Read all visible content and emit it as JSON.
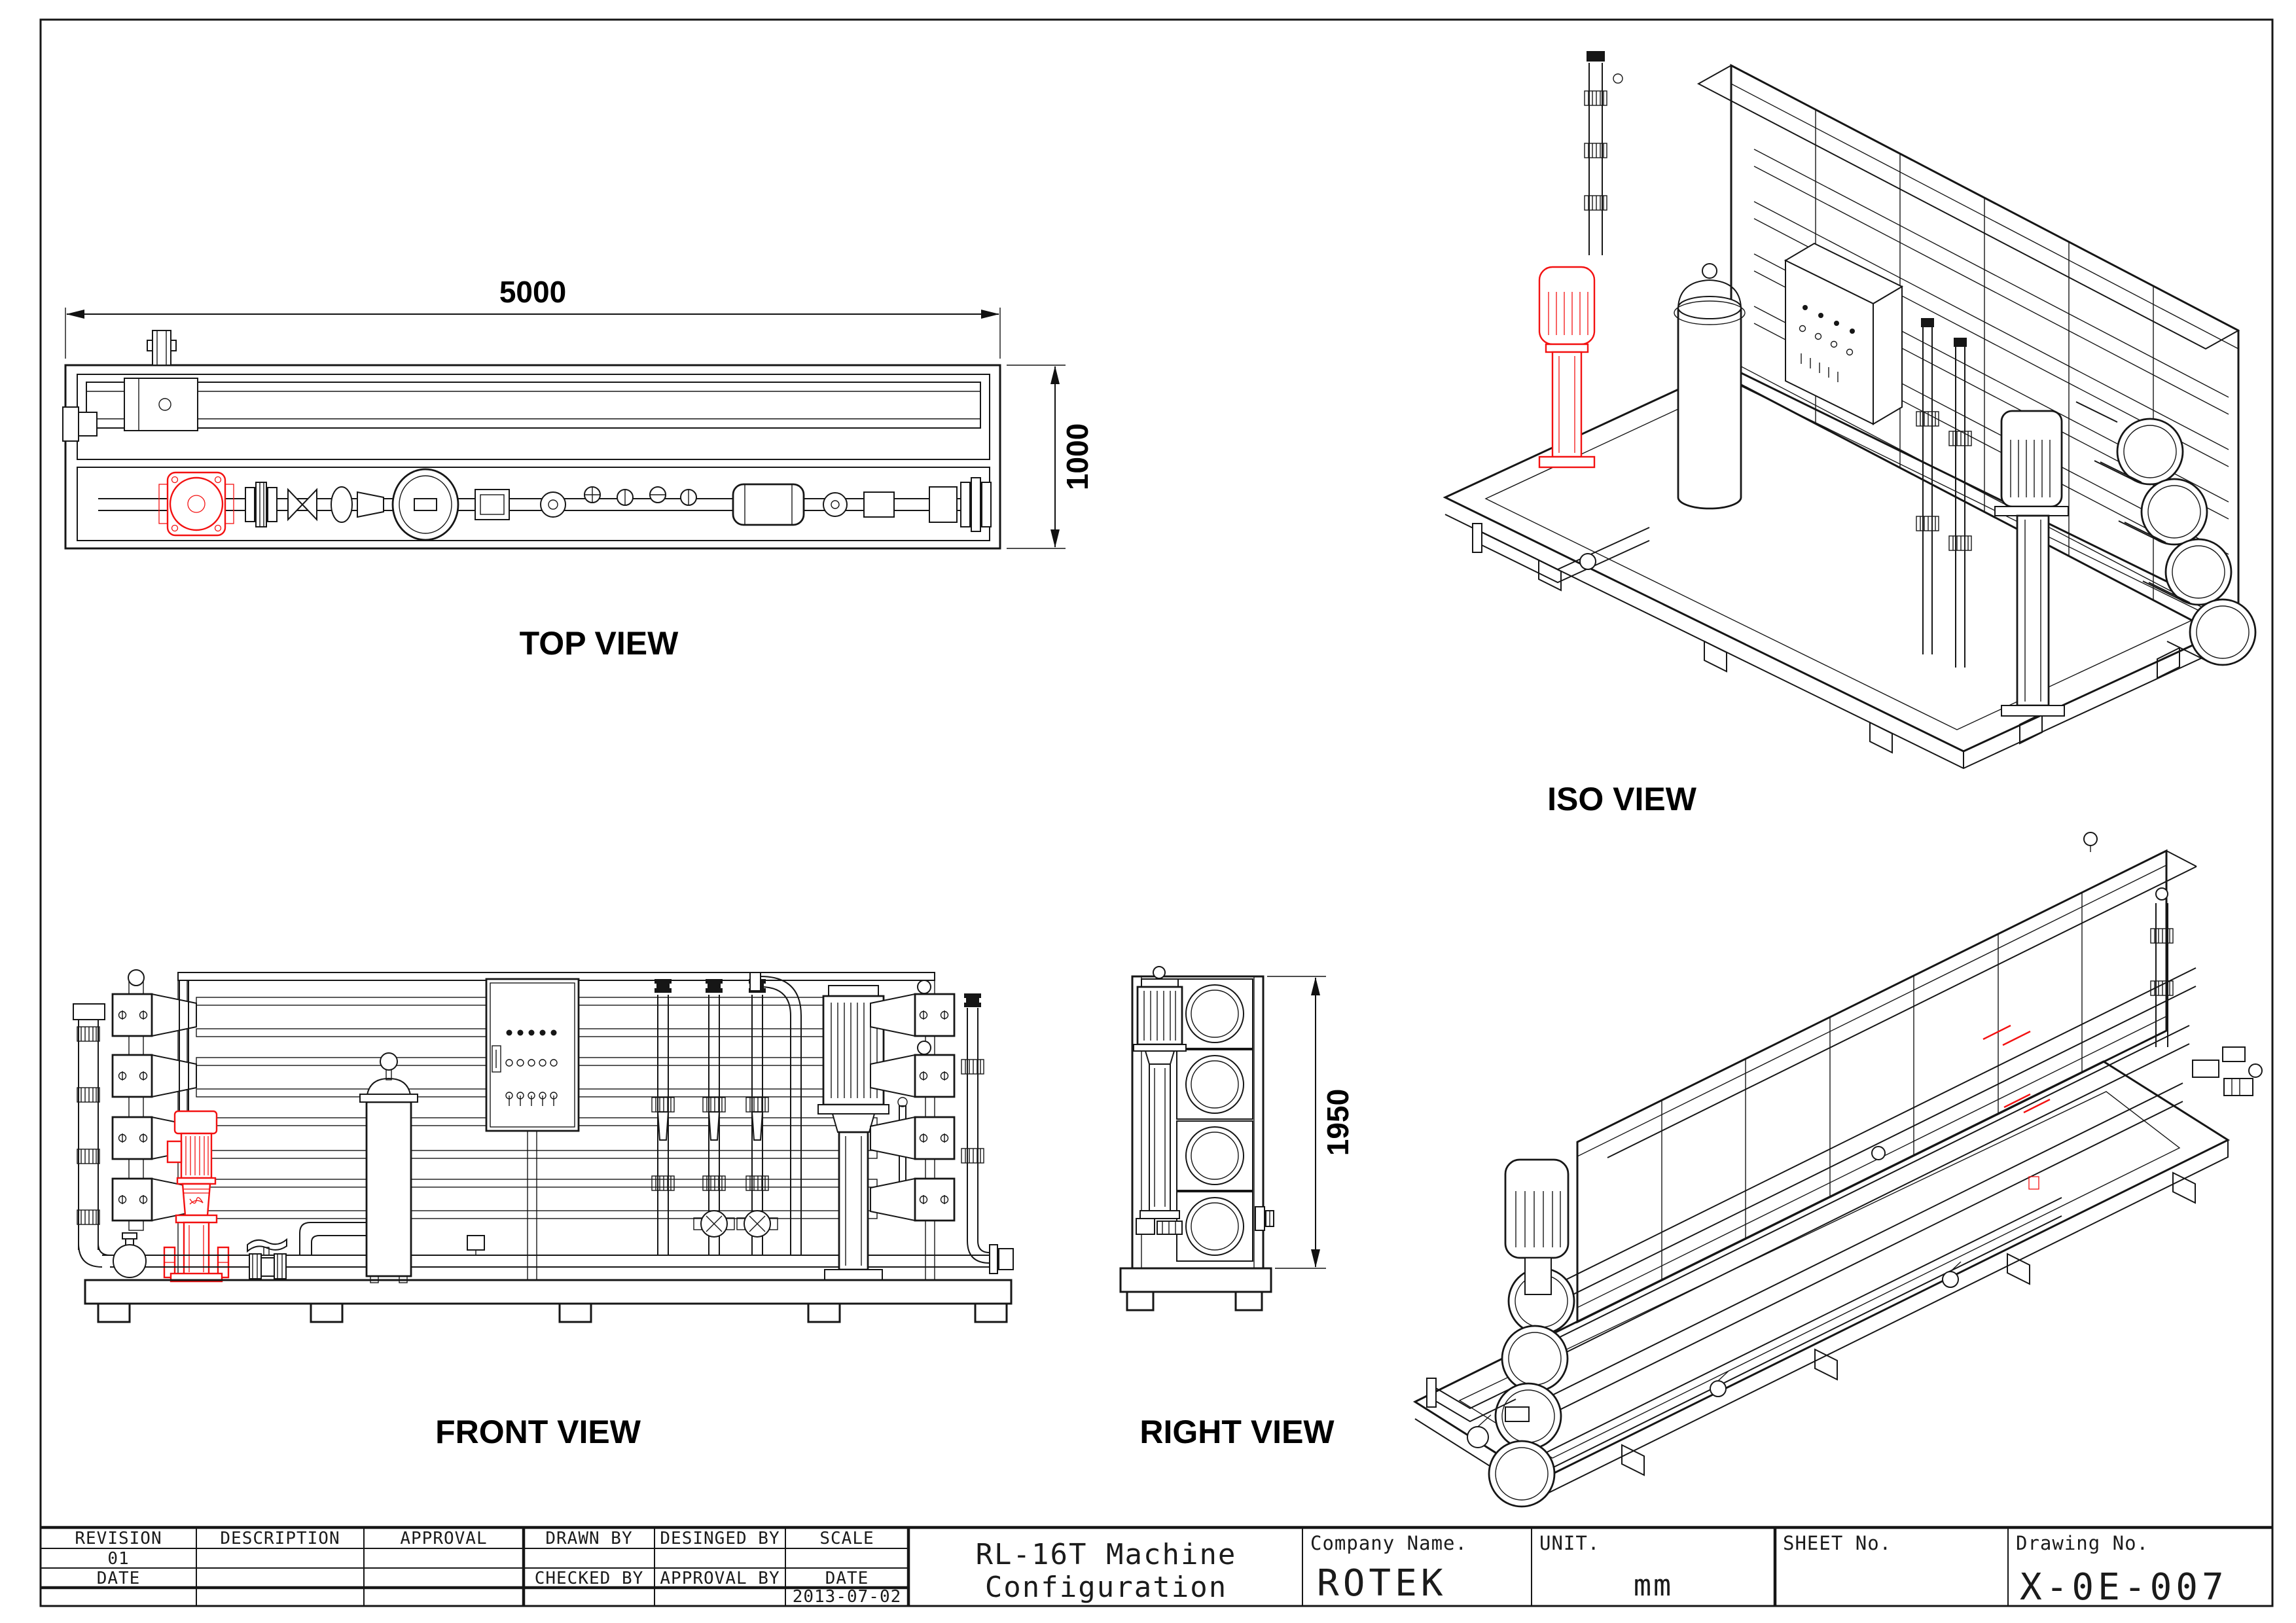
{
  "views": {
    "top": {
      "label": "TOP VIEW",
      "width_dim": "5000",
      "depth_dim": "1000"
    },
    "iso": {
      "label": "ISO VIEW"
    },
    "front": {
      "label": "FRONT VIEW"
    },
    "right": {
      "label": "RIGHT VIEW",
      "height_dim": "1950"
    }
  },
  "title_block": {
    "revision_table": {
      "col_headers": [
        "REVISION",
        "DESCRIPTION",
        "APPROVAL",
        "DRAWN BY",
        "DESINGED BY",
        "SCALE"
      ],
      "revision_no": "01",
      "revision_date_label": "DATE",
      "checked_by_label": "CHECKED BY",
      "approval_by_label": "APPROVAL BY",
      "date_label": "DATE",
      "date_value": "2013-07-02"
    },
    "title": {
      "line1": "RL-16T Machine",
      "line2": "Configuration"
    },
    "company": {
      "label": "Company Name.",
      "value": "ROTEK"
    },
    "unit": {
      "label": "UNIT.",
      "value": "mm"
    },
    "sheet": {
      "label": "SHEET No."
    },
    "drawing": {
      "label": "Drawing No.",
      "value": "X-0E-007"
    }
  },
  "colors": {
    "line": "#161616",
    "accent_red": "#f31111",
    "background": "#ffffff"
  }
}
